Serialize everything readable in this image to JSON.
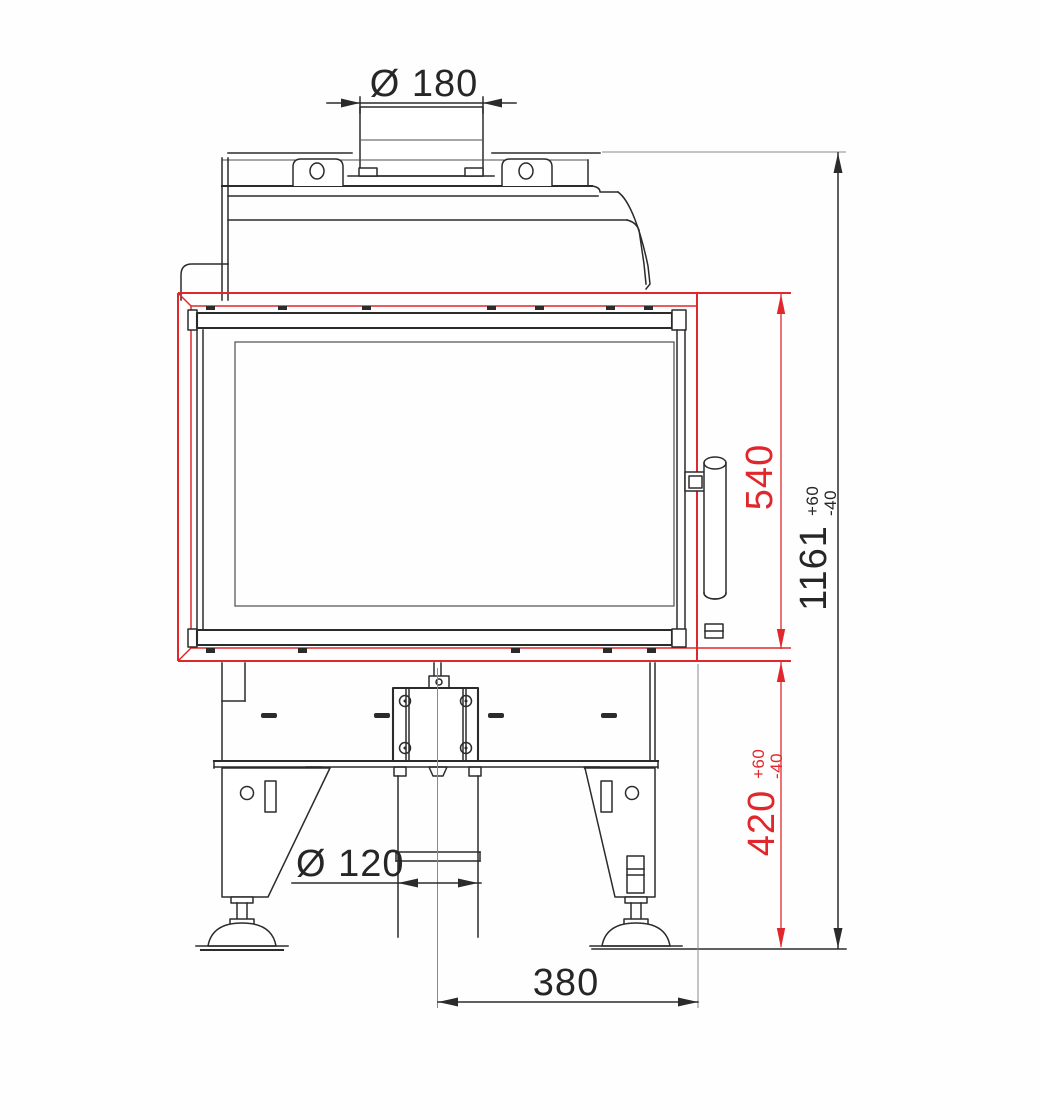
{
  "drawing": {
    "kind": "fireplace-insert-front-view",
    "dimensions": {
      "flue_diameter": "Ø 180",
      "door_frame_height": "540",
      "total_height": "1161",
      "total_height_tol_plus": "+60",
      "total_height_tol_minus": "-40",
      "base_height": "420",
      "base_height_tol_plus": "+60",
      "base_height_tol_minus": "-40",
      "pipe_diameter": "Ø 120",
      "center_to_edge_width": "380"
    },
    "colors": {
      "dimension_red": "#e0282c",
      "line_black": "#2b2b2b",
      "background": "#fefefe"
    }
  }
}
